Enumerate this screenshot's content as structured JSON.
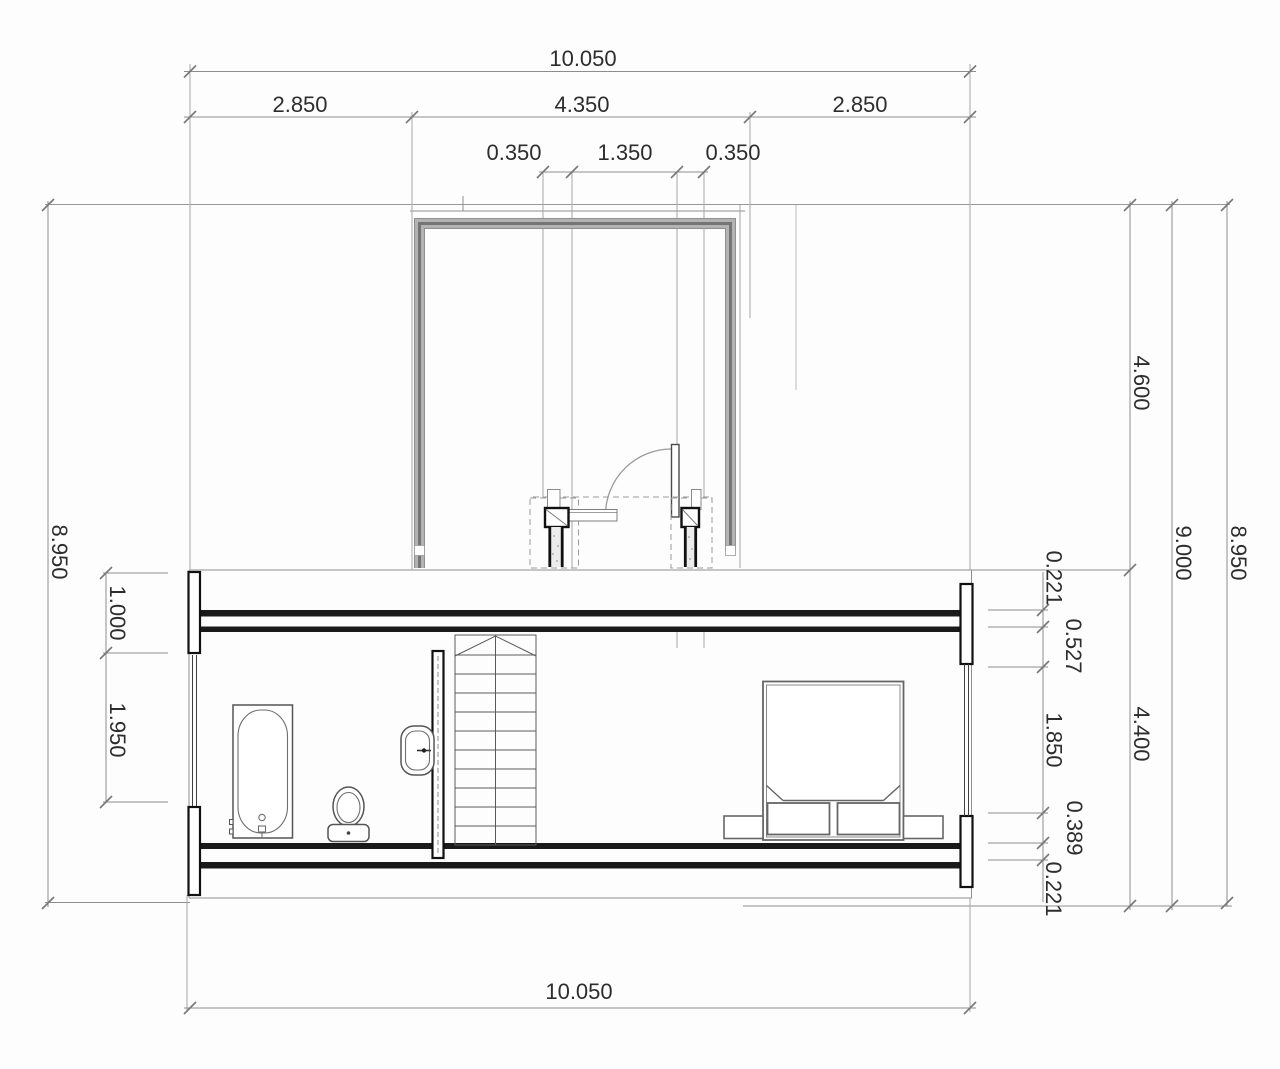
{
  "dimensions": {
    "top_overall": "10.050",
    "top_row2": [
      "2.850",
      "4.350",
      "2.850"
    ],
    "top_row3": [
      "0.350",
      "1.350",
      "0.350"
    ],
    "bottom_overall": "10.050",
    "left_overall": "8.950",
    "left_upper": "1.000",
    "left_lower": "1.950",
    "right_chain": [
      "0.221",
      "0.527",
      "1.850",
      "0.389",
      "0.221"
    ],
    "right_upper": "4.600",
    "right_lower": "4.400",
    "right_height": "9.000",
    "right_overall": "8.950"
  },
  "colors": {
    "background": "#fdfdfd",
    "wall_black": "#1a1a1a",
    "wall_gray": "#b3b3b3",
    "dimension_line": "#8d8d8d",
    "text": "#2d2d2d"
  }
}
